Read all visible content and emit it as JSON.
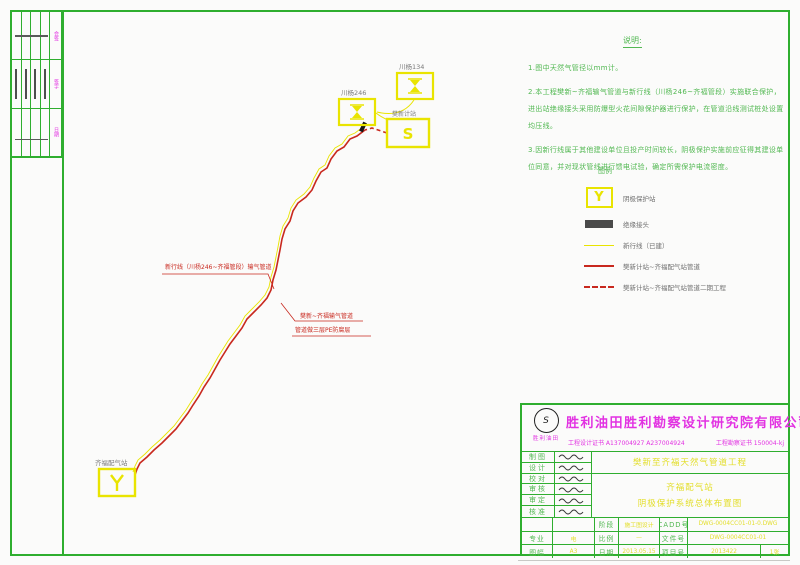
{
  "colors": {
    "frame_green": "#2fae2f",
    "note_green": "#52b852",
    "symbol_yellow": "#e9e400",
    "pipeline_red": "#c8281e",
    "brand_magenta": "#e232e2",
    "label_gray": "#6f6f6f"
  },
  "notes": {
    "title": "说明:",
    "items": [
      "1.图中天然气管径以mm计。",
      "2.本工程樊新~齐福输气管道与新行线（川杨246~齐福管段）实施联合保护，进出站绝缘接头采用防爆型火花间隙保护器进行保护，在管道沿线测试桩处设置均压线。",
      "3.因新行线属于其他建设单位且投产时间较长，阴极保护实施前应征得其建设单位同意，并对现状管线进行馈电试验，确定所需保护电流密度。"
    ]
  },
  "legend": {
    "title": "图例",
    "items": [
      {
        "symbol": "cathodic-protection-station",
        "label": "阴极保护站"
      },
      {
        "symbol": "insulating-joint",
        "label": "绝缘接头"
      },
      {
        "symbol": "existing-new-line",
        "label": "新行线（已建）"
      },
      {
        "symbol": "pipeline-solid",
        "label": "樊新计站~齐福配气站管道"
      },
      {
        "symbol": "pipeline-phase2-dashed",
        "label": "樊新计站~齐福配气站管道二期工程"
      }
    ]
  },
  "map": {
    "well_134": "川杨134",
    "well_246": "川杨246",
    "station_s_label": "樊新计站",
    "station_s_symbol": "S",
    "station_y_label": "齐福配气站",
    "leader_newline": "新行线（川杨246~齐福管段）输气管道",
    "leader_pipeline": "樊新~齐福输气管道",
    "leader_coating": "管道做三层PE防腐层"
  },
  "signoff": {
    "labels": [
      "会签",
      "签字",
      "日期"
    ]
  },
  "titleblock": {
    "company": "胜利油田胜利勘察设计研究院有限公司",
    "logo_text": "胜利油田",
    "logo_mark": "S",
    "cert_design": "工程设计证书 A137004927  A237004924",
    "cert_survey": "工程勘察证书 150004-kj",
    "roles": [
      "制图",
      "设计",
      "校对",
      "审核",
      "审定",
      "核准"
    ],
    "project": "樊新至齐福天然气管道工程",
    "subtitle1": "齐福配气站",
    "subtitle2": "阴极保护系统总体布置图",
    "stage_label": "阶段",
    "stage": "施工图设计",
    "cadd_label": "CADD号",
    "cadd": "DWG-0004CC01-01-0.DWG",
    "major_label": "专业",
    "major": "电",
    "scale_label": "比例",
    "scale": "—",
    "file_label": "文件号",
    "file": "DWG-0004CC01-01",
    "size_label": "图幅",
    "size": "A3",
    "date_label": "日期",
    "date": "2013.05.15",
    "projno_label": "项目号",
    "projno": "2013422",
    "sheet": "1张"
  }
}
